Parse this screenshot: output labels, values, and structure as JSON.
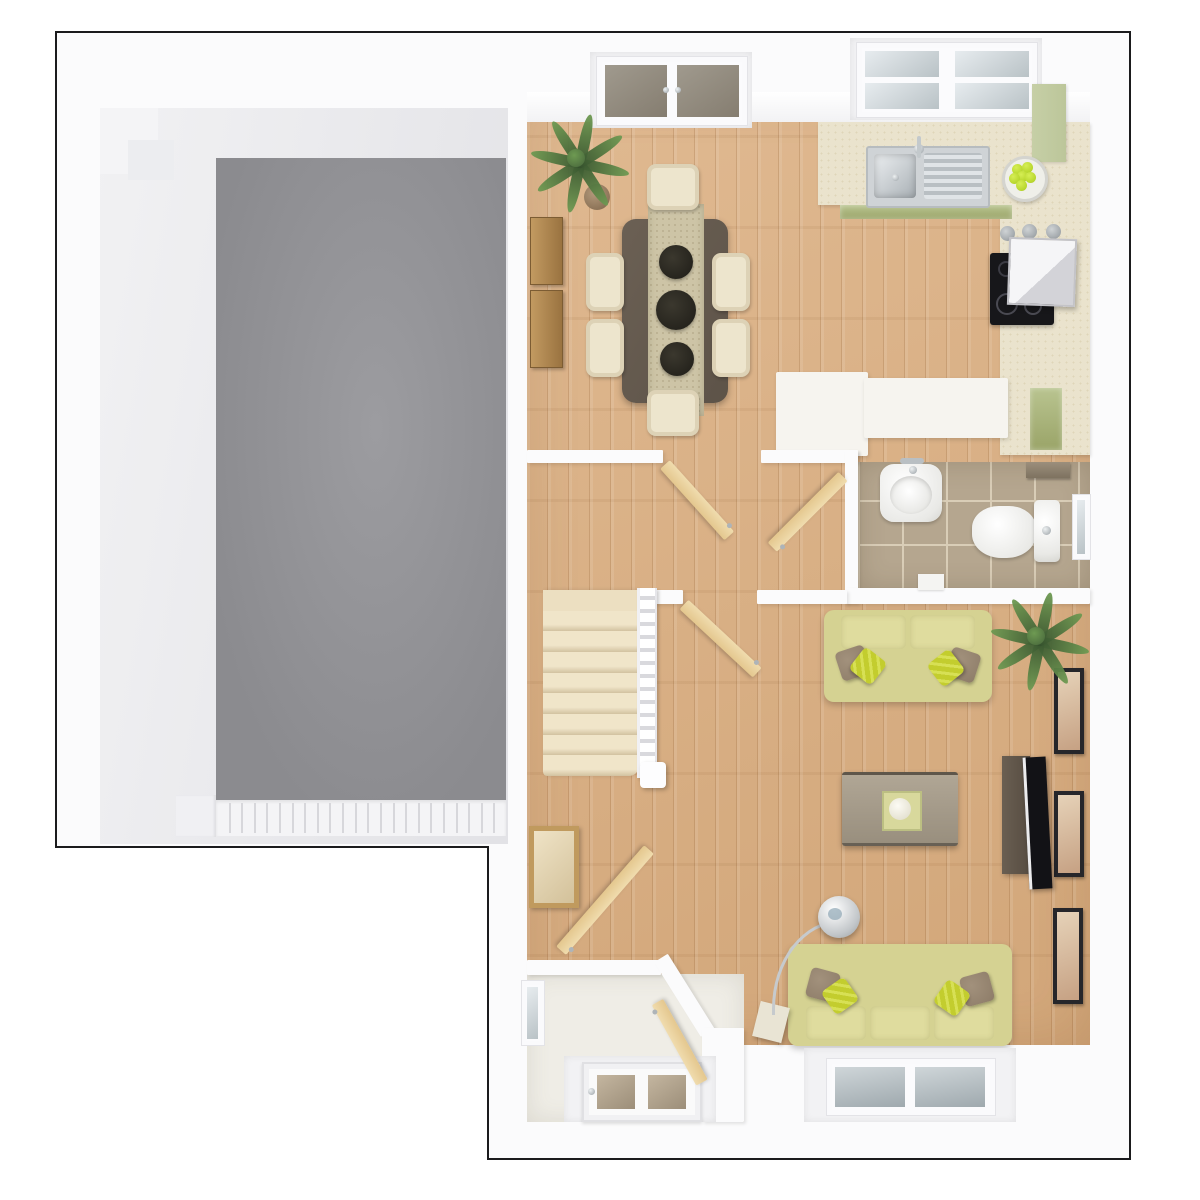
{
  "scene": {
    "kind": "3d-floorplan-top-view",
    "rooms": [
      "garage",
      "dining-area",
      "kitchen",
      "hallway",
      "wc-cloakroom",
      "staircase",
      "living-room",
      "entrance-vestibule"
    ]
  },
  "colors": {
    "outline": "#1b1b1d",
    "wall": "#fbfbfc",
    "garage_floor": "#949498",
    "wood": "#dcb184",
    "carpet": "#ecdfc1",
    "counter": "#eae3cd",
    "cab_green": "#9aa468",
    "cab_green_light": "#bcc69a",
    "sofa": "#d5d292",
    "pillow_lime": "#c3cd2e",
    "pillow_brown": "#8d7c68",
    "table_dark": "#5d5348",
    "runner": "#cdc4a6",
    "chair": "#ede5cd",
    "tile": "#b5a68f",
    "grout": "#d9cdb7",
    "tv_unit": "#564c41",
    "tv_screen": "#121216",
    "frame": "#26262a",
    "art": "#c6a183",
    "leaf_dark": "#46653a",
    "leaf_light": "#6e9a52",
    "glass": "#b9c2c6",
    "glass_dark": "#857d70",
    "door_wood": "#e4c78e",
    "door_wood_edge": "#f0dcae",
    "chrome": "#aeb4b8",
    "cream_floor": "#efede6",
    "apple": "#b7d62c"
  },
  "inventory": {
    "stair_steps": 9,
    "garage_door_ribs": 22,
    "wall_pictures": 3,
    "apples_in_bowl": 6,
    "dining_chairs": 6,
    "table_plant_pots": 3,
    "sofas": 2,
    "lime_pillows": 4,
    "brown_pillows": 4,
    "palm_plants": 2,
    "palm_leaves_each": 8,
    "open_doors": 5,
    "windows": 5
  }
}
